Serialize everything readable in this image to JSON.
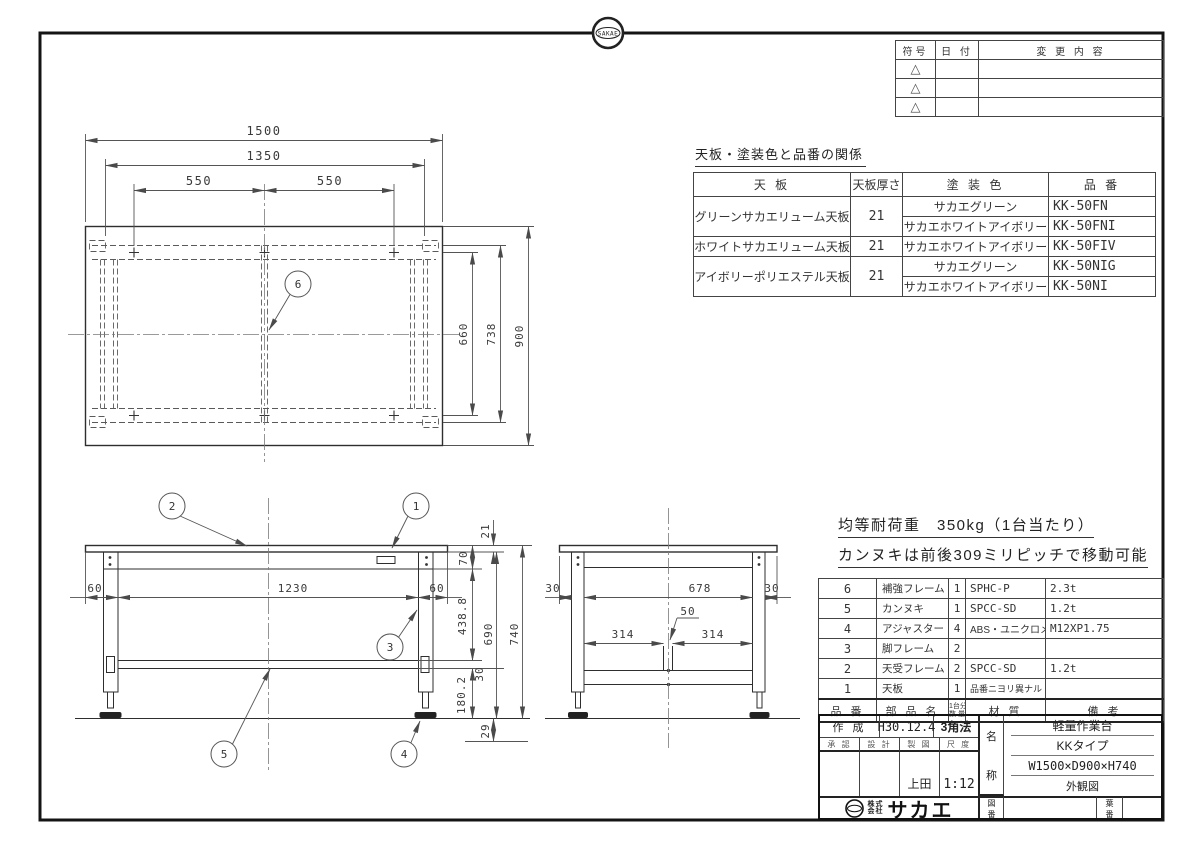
{
  "frame": {
    "stamp_text": "SAKAE"
  },
  "revision_table": {
    "header_symbol": "符号",
    "header_date": "日 付",
    "header_change": "変 更 内 容",
    "triangle": "△"
  },
  "paint_table": {
    "title": "天板・塗装色と品番の関係",
    "header_board": "天 板",
    "header_thickness": "天板厚さ",
    "header_color": "塗 装 色",
    "header_number": "品 番",
    "groups": [
      {
        "board": "グリーンサカエリューム天板",
        "thickness": "21",
        "rows": [
          {
            "color": "サカエグリーン",
            "number": "KK-50FN"
          },
          {
            "color": "サカエホワイトアイボリー",
            "number": "KK-50FNI"
          }
        ]
      },
      {
        "board": "ホワイトサカエリューム天板",
        "thickness": "21",
        "rows": [
          {
            "color": "サカエホワイトアイボリー",
            "number": "KK-50FIV"
          }
        ]
      },
      {
        "board": "アイボリーポリエステル天板",
        "thickness": "21",
        "rows": [
          {
            "color": "サカエグリーン",
            "number": "KK-50NIG"
          },
          {
            "color": "サカエホワイトアイボリー",
            "number": "KK-50NI"
          }
        ]
      }
    ]
  },
  "notes": {
    "line1": "均等耐荷重　350kg（1台当たり）",
    "line2": "カンヌキは前後309ミリピッチで移動可能"
  },
  "parts_table": {
    "header_no": "品 番",
    "header_name": "部 品 名",
    "header_qty_top": "1台分",
    "header_qty_bottom": "数 量",
    "header_material": "材  質",
    "header_remarks": "備  考",
    "rows": [
      {
        "no": "6",
        "name": "補強フレーム",
        "qty": "1",
        "material": "SPHC-P",
        "remarks": "2.3t"
      },
      {
        "no": "5",
        "name": "カンヌキ",
        "qty": "1",
        "material": "SPCC-SD",
        "remarks": "1.2t"
      },
      {
        "no": "4",
        "name": "アジャスター",
        "qty": "4",
        "material": "ABS・ユニクロメッキ",
        "remarks": "M12XP1.75"
      },
      {
        "no": "3",
        "name": "脚フレーム",
        "qty": "2",
        "material": "",
        "remarks": ""
      },
      {
        "no": "2",
        "name": "天受フレーム",
        "qty": "2",
        "material": "SPCC-SD",
        "remarks": "1.2t"
      },
      {
        "no": "1",
        "name": "天板",
        "qty": "1",
        "material": "品番ニヨリ異ナル（上記参照）",
        "remarks": ""
      }
    ]
  },
  "title_block": {
    "created_label": "作 成",
    "created_value": "H30.12.4",
    "projection": "3角法",
    "approved_label": "承 認",
    "design_label": "設 計",
    "draft_label": "製 図",
    "scale_label": "尺 度",
    "draft_value": "上田",
    "scale_value": "1:12",
    "name_label_top": "名",
    "name_label_bottom": "称",
    "name_line1": "軽量作業台",
    "name_line2": "KKタイプ",
    "name_line3": "W1500×D900×H740",
    "name_line4": "外観図",
    "company_prefix_top": "株式",
    "company_prefix_bottom": "会社",
    "company_name": "サカエ",
    "drawing_no_top": "図",
    "drawing_no_bottom": "番",
    "sheet_no_top": "葉",
    "sheet_no_bottom": "番"
  },
  "drawing": {
    "plan": {
      "dim_1500": "1500",
      "dim_1350": "1350",
      "dim_550_left": "550",
      "dim_550_right": "550",
      "dim_660": "660",
      "dim_738": "738",
      "dim_900": "900",
      "balloon_6": "6"
    },
    "front": {
      "dim_60_left": "60",
      "dim_1230": "1230",
      "dim_60_right": "60",
      "dim_21": "21",
      "dim_70": "70",
      "dim_438_8": "438.8",
      "dim_690": "690",
      "dim_740": "740",
      "dim_30": "30",
      "dim_180_2": "180.2",
      "dim_29": "29",
      "balloon_1": "1",
      "balloon_2": "2",
      "balloon_3": "3",
      "balloon_4": "4",
      "balloon_5": "5"
    },
    "side": {
      "dim_30_left": "30",
      "dim_678": "678",
      "dim_30_right": "30",
      "dim_50": "50",
      "dim_314_left": "314",
      "dim_314_right": "314"
    }
  }
}
